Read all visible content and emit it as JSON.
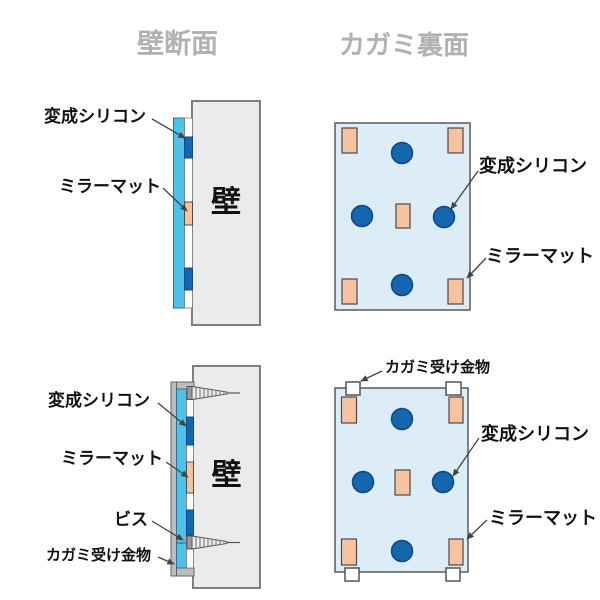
{
  "titles": {
    "wall_section": "壁断面",
    "mirror_back": "カガミ裏面"
  },
  "labels": {
    "silicone": "変成シリコン",
    "mirror_mat": "ミラーマット",
    "wall": "壁",
    "screw": "ビス",
    "bracket": "カガミ受け金物"
  },
  "colors": {
    "title_gray": "#b1b1b1",
    "label_black": "#111111",
    "wall_fill": "#ebebeb",
    "wall_border": "#7f7f7f",
    "mirror_fill": "#4fc2e9",
    "mirror_border": "#2d7193",
    "silicone_fill": "#1565af",
    "silicone_border": "#0e4886",
    "mat_fill": "#f6c2a0",
    "mat_border": "#4a4a4a",
    "mirror_back_fill": "#dcedf8",
    "mirror_back_border": "#5a5a5a",
    "bracket_fill": "#bdbdbd",
    "bracket_border": "#666666",
    "bracket_white": "#ffffff",
    "screw_fill": "#ececec",
    "screw_head": "#9a9a9a",
    "leader": "#444444",
    "strip_border": "#777777"
  }
}
